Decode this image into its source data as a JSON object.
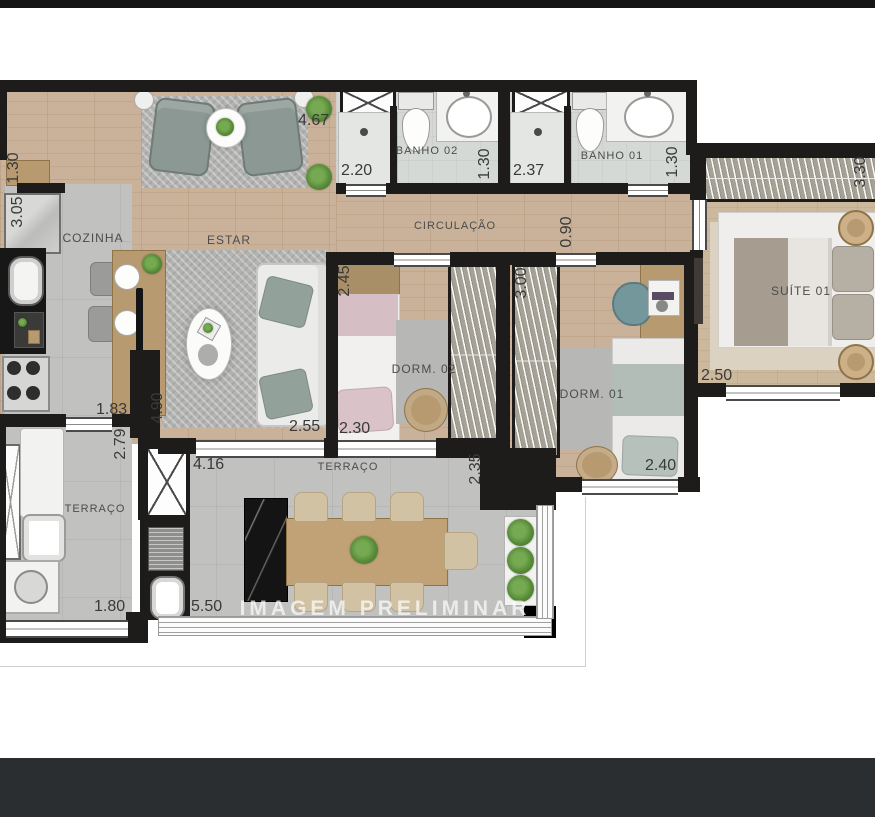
{
  "watermark": "IMAGEM PRELIMINAR",
  "rooms": {
    "estar": "ESTAR",
    "cozinha": "COZINHA",
    "circulacao": "CIRCULAÇÃO",
    "banho02": "BANHO 02",
    "banho01": "BANHO 01",
    "suite01": "SUÍTE 01",
    "dorm02": "DORM. 02",
    "dorm01": "DORM. 01",
    "terraco_servico": "TERRAÇO",
    "terraco_gourmet": "TERRAÇO"
  },
  "dims": {
    "estar_topo": "4.67",
    "entrada": "1.30",
    "cozinha_prof": "3.05",
    "banho02_larg": "2.20",
    "banho02_prof": "1.30",
    "banho01_larg": "2.37",
    "banho01_prof": "1.30",
    "suite_armario": "3.30",
    "circulacao_larg": "0.90",
    "dorm02_prof": "2.45",
    "dorm01_prof": "3.00",
    "suite_larg": "2.50",
    "cozinha_larg": "1.83",
    "terraco_servico_prof": "2.79",
    "estar_prof": "4.90",
    "estar_larg": "2.55",
    "dorm02_larg": "2.30",
    "dorm01_larg": "2.40",
    "terraco_prof": "2.35",
    "terraco_larg": "4.16",
    "terraco_servico_larg": "1.80",
    "terraco_gourmet_larg": "5.50"
  },
  "colors": {
    "wall": "#1d1c1a",
    "wood_floor": "#c9b299",
    "tile_floor": "#c1c1bf",
    "plant_green": "#568a37",
    "top_bar": "#151515",
    "bottom_bar": "#2b2e30"
  }
}
